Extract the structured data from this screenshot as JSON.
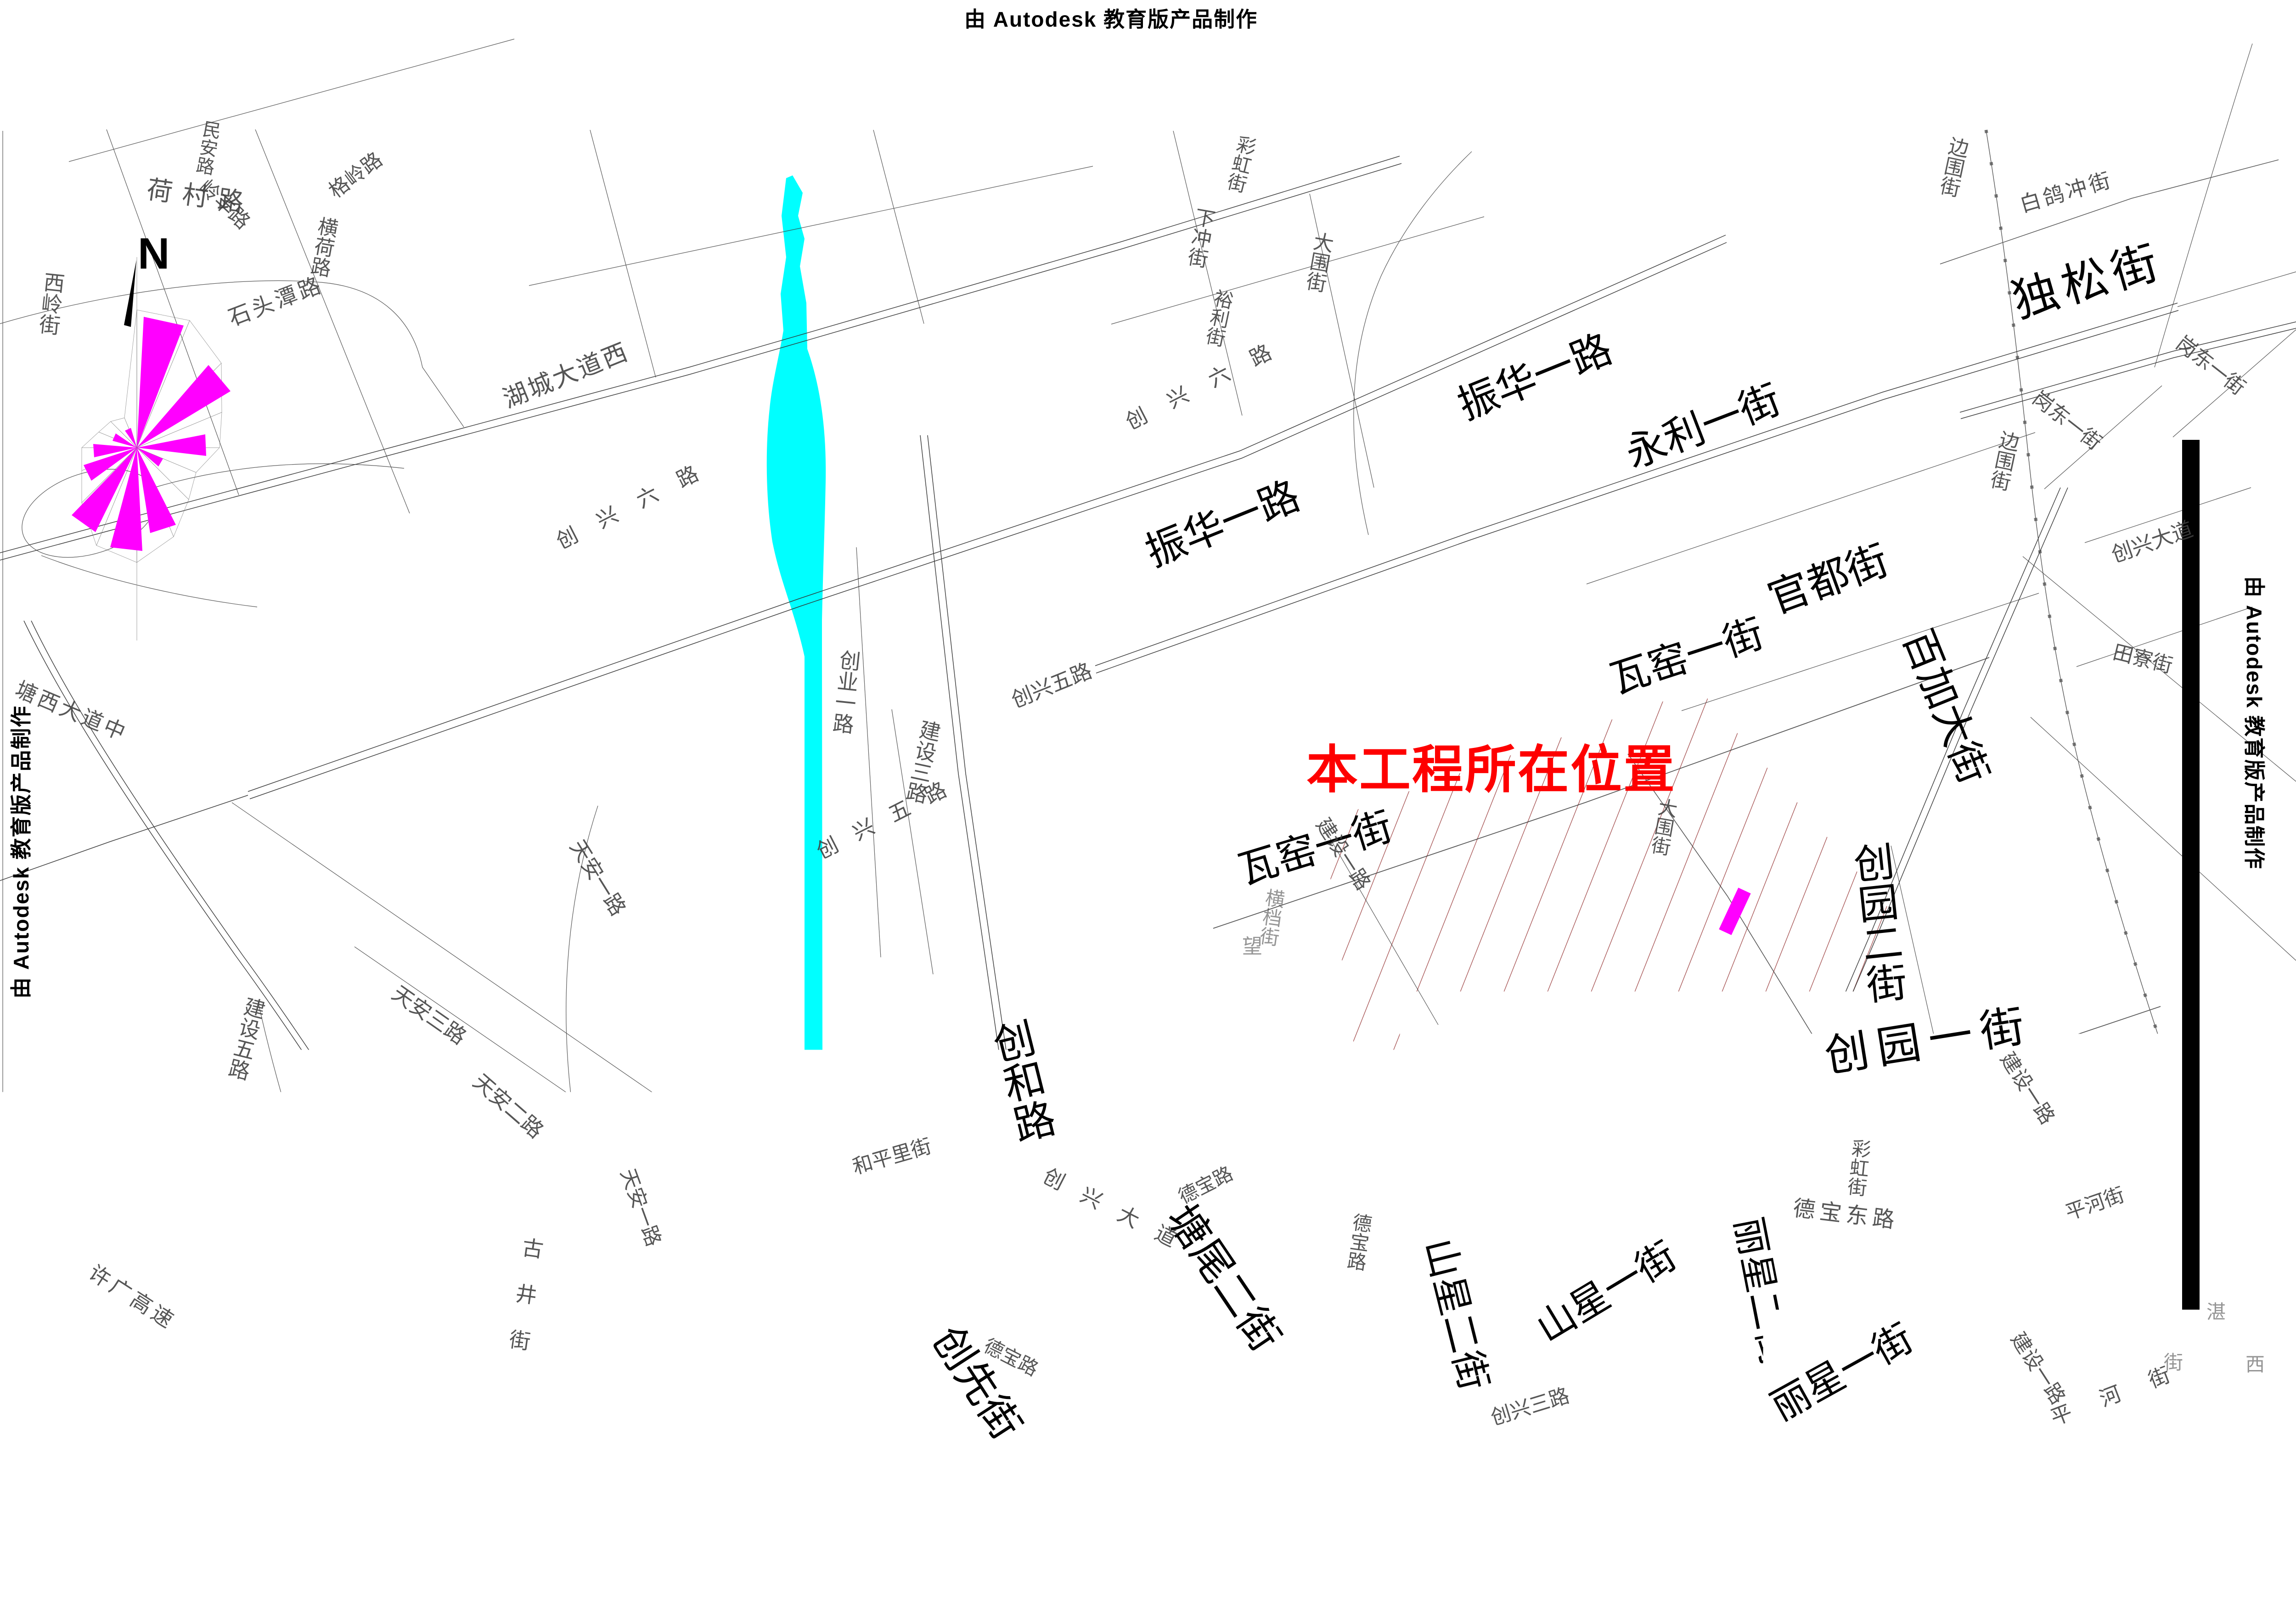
{
  "watermark": {
    "text": "由 Autodesk 教育版产品制作"
  },
  "annotation": {
    "project_location": "本工程所在位置"
  },
  "compass": {
    "north": "N"
  },
  "colors": {
    "river": "#00FFFF",
    "wind_rose": "#FF00FF",
    "project_marker": "#FF00FF",
    "annotation_text": "#FE0000",
    "hatch": "#A04848",
    "road_line": "#303030",
    "survey_bar": "#000000"
  },
  "major_streets": {
    "dusong": "独松街",
    "zhenhua_a": "振华一路",
    "zhenhua_b": "振华一路",
    "yongli": "永利一街",
    "guandu": "官都街",
    "wayao_a": "瓦窑一街",
    "wayao_b": "瓦窑一街",
    "baijia": "百加大街",
    "chuangyuan2": "创园二街",
    "chuangyuan1": "创园一街",
    "chuanghe": "创和路",
    "chuangxian": "创先街",
    "tangwei": "塘尾二街",
    "shanxing2": "山星二街",
    "shanxing1": "山星一街",
    "lixing2": "丽星二街",
    "lixing1": "丽星一街"
  },
  "minor_streets": {
    "hecun": "荷村路",
    "minan": "民安路",
    "lingfeng": "岭丰路",
    "shitoutan": "石头潭路",
    "geling": "格岭路",
    "henghe": "横荷路",
    "xiling": "西岭街",
    "hucheng": "湖城大道西",
    "chuangxing6_a": "创兴六路",
    "chuangxing6_b": "创兴六路",
    "xiachong": "下冲街",
    "caihong_a": "彩虹街",
    "yuli": "裕利街",
    "dawei_a": "大围街",
    "dawei_b": "大围街",
    "chuangye": "创业一路",
    "jianshe3": "建设三路",
    "chuangxing5_a": "创兴五路",
    "chuangxing5_b": "创兴五路",
    "jianshe1_a": "建设一路",
    "hengdang": "横档街",
    "jianshe1_b": "建设一路",
    "debao_dong": "德宝东路",
    "debao_a": "德宝路",
    "debao_b": "德宝路",
    "debao_c": "德宝路",
    "tianan1_a": "天安一路",
    "tianan1_b": "天安一路",
    "tianan3": "天安三路",
    "tianan2": "天安二路",
    "jianshe5": "建设五路",
    "tangxi": "塘西大道中",
    "xuguang": "许广高速",
    "gujing": "古井街",
    "hepingli": "和平里街",
    "chuangxingdadao_a": "创兴大道",
    "chuangxingdadao_b": "创兴大道",
    "tianliao": "田寮街",
    "chuangxing3": "创兴三路",
    "caihong_b": "彩虹街",
    "baigechong": "白鸽冲街",
    "bianwei_a": "边围街",
    "bianwei_b": "边围街",
    "gangdong_a": "岗东一街",
    "gangdong_b": "岗东一街",
    "pinghe_a": "平河街",
    "jianshe1_c": "建设一路",
    "pinghe_b": "平河街"
  },
  "scatter_chars": {
    "wang": "望",
    "zhan": "湛",
    "jie": "街",
    "xi": "西"
  }
}
